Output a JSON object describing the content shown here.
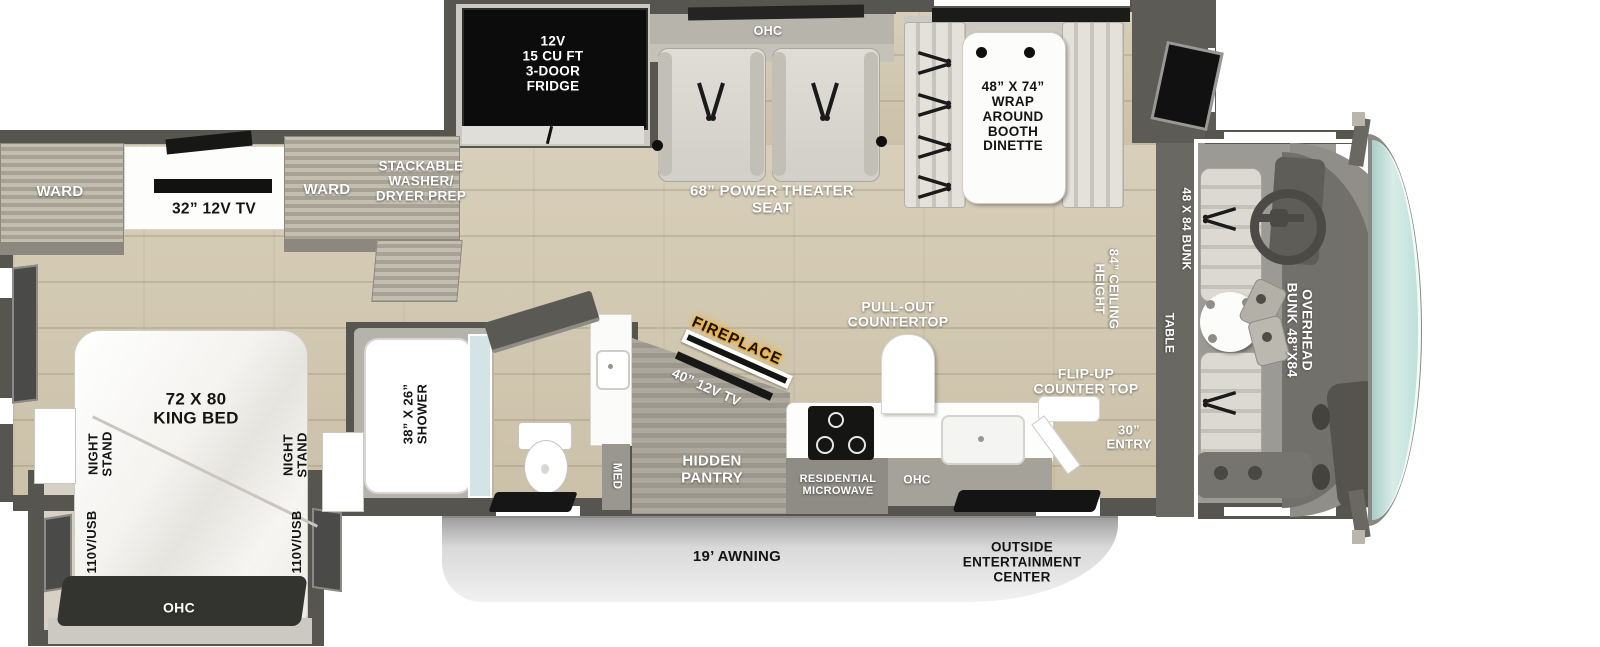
{
  "plan_title": "RV motorhome floor plan",
  "colors": {
    "floor": "#d2c9b2",
    "wall": "#57554f",
    "cabinet_wood": "#b5b0a5",
    "fridge": "#0d0d0d",
    "fireplace_glow": "#ffa200",
    "windshield": "#bfdfd8",
    "awning_band": "#d9d9d9",
    "mat": "#151515",
    "label_white": "#ffffff",
    "label_black": "#141414"
  },
  "labels": {
    "fridge": "12V\n15 CU FT\n3-DOOR\nFRIDGE",
    "ohc_galley_top": "OHC",
    "theater_seat": "68” POWER THEATER\nSEAT",
    "dinette": "48” X 74”\nWRAP\nAROUND\nBOOTH\nDINETTE",
    "ward_front": "WARD",
    "bedroom_tv": "32” 12V TV",
    "ward_rear": "WARD",
    "washer_dryer": "STACKABLE\nWASHER/\nDRYER PREP",
    "king_bed": "72 X 80\nKING BED",
    "night_stand": "NIGHT\nSTAND",
    "outlet": "110V/USB",
    "ohc_bed": "OHC",
    "shower": "38” X 26”\nSHOWER",
    "med": "MED",
    "hidden_pantry": "HIDDEN\nPANTRY",
    "fireplace": "FIREPLACE",
    "tv_40": "40” 12V TV",
    "pull_out": "PULL-OUT\nCOUNTERTOP",
    "flip_up": "FLIP-UP\nCOUNTER TOP",
    "microwave": "RESIDENTIAL\nMICROWAVE",
    "ohc_kitchen": "OHC",
    "entry": "30”\nENTRY",
    "ceiling": "84” CEILING\nHEIGHT",
    "table": "TABLE",
    "cab_bunk": "48 X 84 BUNK",
    "overhead_bunk": "OVERHEAD\nBUNK 48”X84",
    "awning": "19’ AWNING",
    "outside_ent": "OUTSIDE\nENTERTAINMENT\nCENTER"
  }
}
